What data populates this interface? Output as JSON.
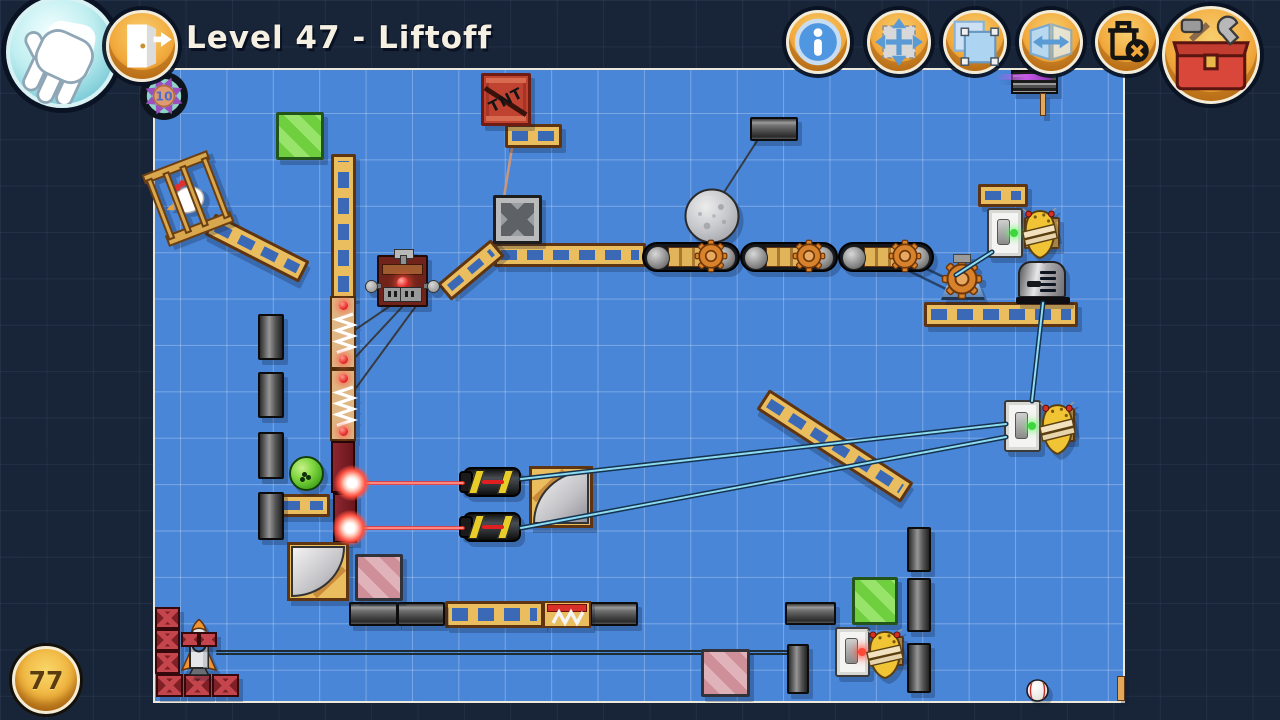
{
  "title": "Level 47 - Liftoff",
  "hud": {
    "left_toolbar": [
      {
        "id": "hand-tool",
        "icon": "hand-icon"
      },
      {
        "id": "exit",
        "icon": "exit-door-icon"
      }
    ],
    "toolbar": [
      {
        "id": "info",
        "icon": "info-icon"
      },
      {
        "id": "move",
        "icon": "move-arrows-icon"
      },
      {
        "id": "select",
        "icon": "selection-icon"
      },
      {
        "id": "flip",
        "icon": "flip-horizontal-icon"
      },
      {
        "id": "delete",
        "icon": "trash-delete-icon"
      },
      {
        "id": "toolbox",
        "icon": "toolbox-icon"
      }
    ],
    "parts_badge": {
      "value": "10"
    },
    "score_badge": {
      "value": "77"
    }
  },
  "colors": {
    "outer_navy": "#182438",
    "play_field_blue": "#4a86d8",
    "hud_button_orange": "#f2a93c",
    "toolbox_red": "#d9473a",
    "title_cream": "#f5f0e2",
    "laser_red": "#ff2a20",
    "belt_cyan": "#8edcf2",
    "wood_tan": "#eabd5f",
    "brick_maroon": "#7c2128"
  },
  "scene": {
    "labels": {
      "tnt": "TNT"
    },
    "objects": [
      {
        "t": "girder",
        "x": 505,
        "y": 124,
        "w": 57,
        "h": 24
      },
      {
        "t": "girder",
        "x": 494,
        "y": 243,
        "w": 152,
        "h": 24
      },
      {
        "t": "girder",
        "x": 436,
        "y": 259,
        "w": 70,
        "h": 22,
        "r": -40
      },
      {
        "t": "girder-v",
        "x": 331,
        "y": 154,
        "w": 25,
        "h": 145
      },
      {
        "t": "girder",
        "x": 277,
        "y": 494,
        "w": 53,
        "h": 23
      },
      {
        "t": "girder",
        "x": 445,
        "y": 601,
        "w": 99,
        "h": 27
      },
      {
        "t": "girder",
        "x": 978,
        "y": 184,
        "w": 50,
        "h": 23
      },
      {
        "t": "girder",
        "x": 924,
        "y": 302,
        "w": 154,
        "h": 25
      },
      {
        "t": "girder",
        "x": 749,
        "y": 434,
        "w": 172,
        "h": 24,
        "r": 33
      },
      {
        "t": "girder",
        "x": 204,
        "y": 236,
        "w": 106,
        "h": 24,
        "r": 27
      },
      {
        "t": "block-v",
        "x": 258,
        "y": 314,
        "w": 26,
        "h": 46
      },
      {
        "t": "block-v",
        "x": 258,
        "y": 372,
        "w": 26,
        "h": 46
      },
      {
        "t": "block-v",
        "x": 258,
        "y": 432,
        "w": 26,
        "h": 47
      },
      {
        "t": "block-v",
        "x": 258,
        "y": 492,
        "w": 26,
        "h": 48
      },
      {
        "t": "block-h",
        "x": 750,
        "y": 117,
        "w": 48,
        "h": 24
      },
      {
        "t": "block-h",
        "x": 349,
        "y": 602,
        "w": 49,
        "h": 24
      },
      {
        "t": "block-h",
        "x": 397,
        "y": 602,
        "w": 48,
        "h": 24
      },
      {
        "t": "block-h",
        "x": 590,
        "y": 602,
        "w": 48,
        "h": 24
      },
      {
        "t": "block-h",
        "x": 785,
        "y": 602,
        "w": 51,
        "h": 23
      },
      {
        "t": "block-v",
        "x": 907,
        "y": 527,
        "w": 24,
        "h": 45
      },
      {
        "t": "block-v",
        "x": 907,
        "y": 578,
        "w": 24,
        "h": 54
      },
      {
        "t": "block-v",
        "x": 907,
        "y": 643,
        "w": 24,
        "h": 50
      },
      {
        "t": "block-v",
        "x": 787,
        "y": 644,
        "w": 22,
        "h": 50
      },
      {
        "t": "crate-green",
        "x": 276,
        "y": 112,
        "w": 48,
        "h": 48
      },
      {
        "t": "crate-green",
        "x": 852,
        "y": 577,
        "w": 46,
        "h": 48
      },
      {
        "t": "crate-pink",
        "x": 355,
        "y": 554,
        "w": 48,
        "h": 47
      },
      {
        "t": "crate-pink",
        "x": 701,
        "y": 649,
        "w": 49,
        "h": 48
      },
      {
        "t": "tnt",
        "x": 481,
        "y": 73,
        "w": 50,
        "h": 53
      },
      {
        "t": "metal-crate",
        "x": 493,
        "y": 195,
        "w": 49,
        "h": 49
      },
      {
        "t": "moon",
        "x": 684,
        "y": 188,
        "w": 56,
        "h": 56
      },
      {
        "t": "conveyor",
        "x": 642,
        "y": 242,
        "w": 98,
        "h": 30
      },
      {
        "t": "conveyor",
        "x": 740,
        "y": 242,
        "w": 98,
        "h": 30
      },
      {
        "t": "conveyor",
        "x": 838,
        "y": 242,
        "w": 96,
        "h": 30
      },
      {
        "t": "spring",
        "x": 330,
        "y": 296,
        "w": 26,
        "h": 73
      },
      {
        "t": "spring",
        "x": 330,
        "y": 369,
        "w": 26,
        "h": 72
      },
      {
        "t": "brick",
        "x": 331,
        "y": 441,
        "w": 24,
        "h": 52
      },
      {
        "t": "brick",
        "x": 333,
        "y": 493,
        "w": 24,
        "h": 50
      },
      {
        "t": "detonator",
        "x": 377,
        "y": 255,
        "w": 51,
        "h": 52
      },
      {
        "t": "laser-gun",
        "x": 463,
        "y": 467,
        "w": 58,
        "h": 30
      },
      {
        "t": "laser-gun",
        "x": 463,
        "y": 512,
        "w": 58,
        "h": 30
      },
      {
        "t": "mirror",
        "x": 529,
        "y": 466,
        "w": 64,
        "h": 62,
        "v": "tl"
      },
      {
        "t": "mirror",
        "x": 287,
        "y": 542,
        "w": 62,
        "h": 59,
        "v": "br"
      },
      {
        "t": "motor",
        "x": 940,
        "y": 258,
        "w": 46,
        "h": 45
      },
      {
        "t": "toaster",
        "x": 1016,
        "y": 261,
        "w": 54,
        "h": 43
      },
      {
        "t": "spring-box",
        "x": 543,
        "y": 601,
        "w": 48,
        "h": 27
      },
      {
        "t": "wood-back",
        "x": 1024,
        "y": 217,
        "w": 36,
        "h": 32
      },
      {
        "t": "wood-back",
        "x": 1055,
        "y": 408,
        "w": 20,
        "h": 34
      },
      {
        "t": "wood-back",
        "x": 876,
        "y": 636,
        "w": 28,
        "h": 30
      },
      {
        "t": "switch",
        "x": 987,
        "y": 208,
        "w": 36,
        "h": 50,
        "dot": "green"
      },
      {
        "t": "hive",
        "x": 1021,
        "y": 208,
        "w": 38,
        "h": 52
      },
      {
        "t": "switch",
        "x": 1004,
        "y": 400,
        "w": 37,
        "h": 52,
        "dot": "green"
      },
      {
        "t": "hive",
        "x": 1038,
        "y": 402,
        "w": 39,
        "h": 54
      },
      {
        "t": "switch",
        "x": 835,
        "y": 627,
        "w": 35,
        "h": 50,
        "dot": "red"
      },
      {
        "t": "hive",
        "x": 865,
        "y": 629,
        "w": 40,
        "h": 51
      },
      {
        "t": "cage",
        "x": 153,
        "y": 160,
        "w": 70,
        "h": 77,
        "r": -21
      },
      {
        "t": "ball-green",
        "x": 289,
        "y": 456,
        "w": 35,
        "h": 35
      },
      {
        "t": "truss",
        "x": 155,
        "y": 607,
        "w": 25,
        "h": 22
      },
      {
        "t": "truss",
        "x": 155,
        "y": 629,
        "w": 25,
        "h": 22
      },
      {
        "t": "truss",
        "x": 155,
        "y": 651,
        "w": 25,
        "h": 23
      },
      {
        "t": "truss",
        "x": 156,
        "y": 674,
        "w": 27,
        "h": 23
      },
      {
        "t": "truss",
        "x": 184,
        "y": 674,
        "w": 27,
        "h": 23
      },
      {
        "t": "truss",
        "x": 212,
        "y": 674,
        "w": 27,
        "h": 23
      },
      {
        "t": "rocket",
        "x": 179,
        "y": 618,
        "w": 40,
        "h": 59
      },
      {
        "t": "truss",
        "x": 181,
        "y": 632,
        "w": 18,
        "h": 15
      },
      {
        "t": "truss",
        "x": 199,
        "y": 632,
        "w": 18,
        "h": 15
      },
      {
        "t": "sign",
        "x": 1011,
        "y": 70,
        "w": 47,
        "h": 24
      },
      {
        "t": "stick",
        "x": 1040,
        "y": 93,
        "w": 6,
        "h": 23
      },
      {
        "t": "stick",
        "x": 1117,
        "y": 676,
        "w": 8,
        "h": 25
      },
      {
        "t": "baseball",
        "x": 1026,
        "y": 679,
        "w": 23,
        "h": 23
      },
      {
        "t": "spark",
        "x": 334,
        "y": 465,
        "w": 36,
        "h": 36
      },
      {
        "t": "spark",
        "x": 332,
        "y": 510,
        "w": 36,
        "h": 36
      }
    ],
    "lines": [
      {
        "k": "tan",
        "x1": 512,
        "y1": 148,
        "x2": 504,
        "y2": 197
      },
      {
        "k": "rope",
        "x1": 757,
        "y1": 141,
        "x2": 721,
        "y2": 197
      },
      {
        "k": "rope",
        "x1": 390,
        "y1": 306,
        "x2": 346,
        "y2": 336
      },
      {
        "k": "rope",
        "x1": 403,
        "y1": 306,
        "x2": 349,
        "y2": 364
      },
      {
        "k": "rope",
        "x1": 416,
        "y1": 306,
        "x2": 353,
        "y2": 392
      },
      {
        "k": "rope2",
        "x1": 217,
        "y1": 651,
        "x2": 788,
        "y2": 651
      },
      {
        "k": "navy",
        "x1": 906,
        "y1": 259,
        "x2": 952,
        "y2": 281
      },
      {
        "k": "navy",
        "x1": 903,
        "y1": 268,
        "x2": 948,
        "y2": 290
      },
      {
        "k": "belt",
        "x1": 521,
        "y1": 479,
        "x2": 1006,
        "y2": 424
      },
      {
        "k": "belt",
        "x1": 521,
        "y1": 528,
        "x2": 1006,
        "y2": 437
      },
      {
        "k": "belt",
        "x1": 956,
        "y1": 275,
        "x2": 992,
        "y2": 252
      },
      {
        "k": "belt",
        "x1": 1043,
        "y1": 303,
        "x2": 1032,
        "y2": 401
      },
      {
        "k": "laser",
        "x1": 358,
        "y1": 483,
        "x2": 463,
        "y2": 483
      },
      {
        "k": "laser",
        "x1": 356,
        "y1": 528,
        "x2": 463,
        "y2": 528
      }
    ]
  }
}
